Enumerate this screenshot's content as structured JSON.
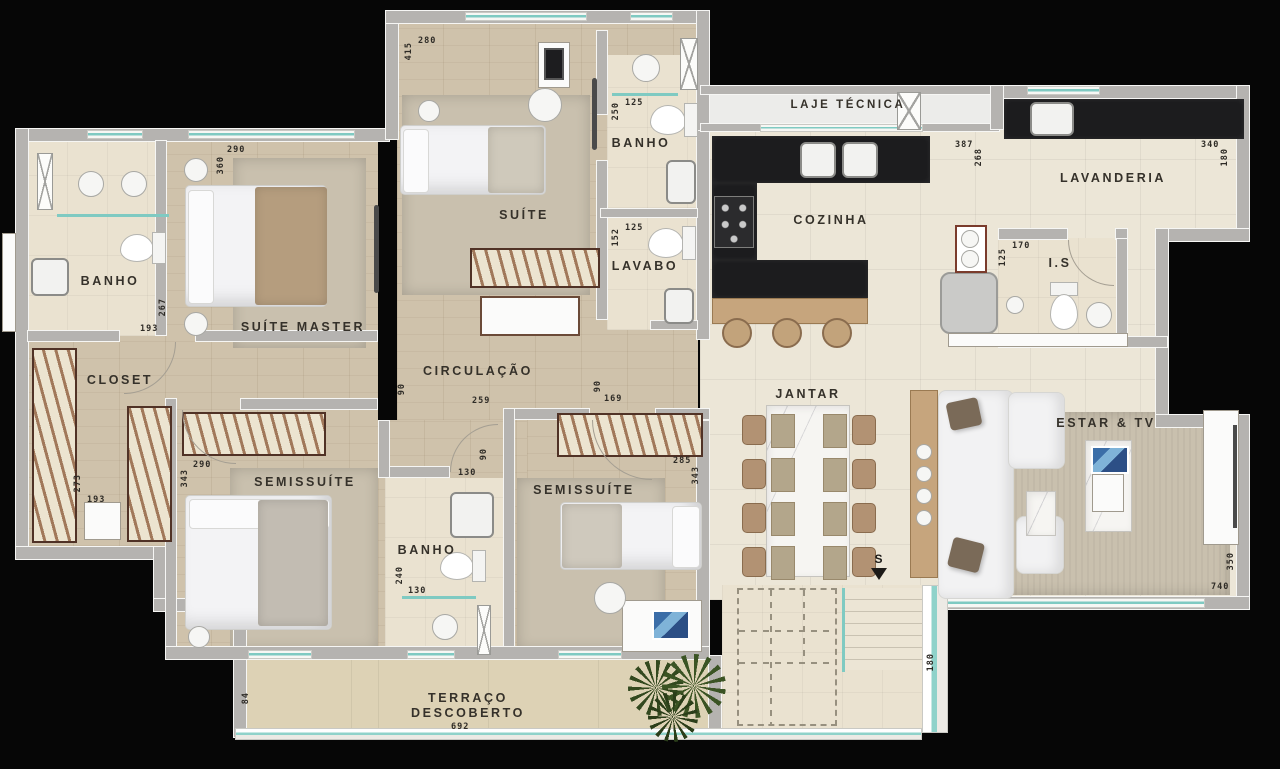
{
  "plan_type": "apartment-floor-plan",
  "palette": {
    "background": "#060606",
    "wall": "#b5b3b0",
    "wood_floor": "#cfc2ab",
    "tile_floor": "#ece6d7",
    "bath_floor": "#eae2d0",
    "terrace_floor": "#ddd2b5",
    "window_teal": "#7fcac2",
    "counter_black": "#1c1c1e",
    "label_color": "#35312a"
  },
  "rooms": {
    "banho_left": {
      "label": "BANHO",
      "dim_w": "193",
      "dim_h": "267"
    },
    "suite_master": {
      "label": "SUÍTE MASTER",
      "dim_w": "290",
      "dim_h": "360"
    },
    "closet": {
      "label": "CLOSET",
      "dim_w": "193",
      "dim_h": "273"
    },
    "semissuite_1": {
      "label": "SEMISSUÍTE",
      "dim_w": "290",
      "dim_h": "343"
    },
    "suite": {
      "label": "SUÍTE",
      "dim_w": "280",
      "dim_h": "415"
    },
    "banho_top": {
      "label": "BANHO",
      "dim_w": "125",
      "dim_h": "250"
    },
    "lavabo": {
      "label": "LAVABO",
      "dim_w": "125",
      "dim_h": "152"
    },
    "circulacao": {
      "label": "CIRCULAÇÃO",
      "dim_w_left": "259",
      "dim_w_right": "169",
      "dim_door_left": "90",
      "dim_door_right": "90"
    },
    "banho_bottom": {
      "label": "BANHO",
      "dim_w": "130",
      "dim_h": "240",
      "dim_door": "130",
      "dim_hall": "90"
    },
    "semissuite_2": {
      "label": "SEMISSUÍTE",
      "dim_w": "285",
      "dim_h": "343"
    },
    "laje_tecnica": {
      "label": "LAJE TÉCNICA"
    },
    "cozinha": {
      "label": "COZINHA",
      "dim_w": "387",
      "dim_h": "268"
    },
    "lavanderia": {
      "label": "LAVANDERIA",
      "dim_w": "340",
      "dim_h": "180"
    },
    "is": {
      "label": "I.S",
      "dim_w": "170",
      "dim_h": "125"
    },
    "jantar": {
      "label": "JANTAR"
    },
    "estar_tv": {
      "label": "ESTAR & TV",
      "dim_w": "740",
      "dim_h": "350"
    },
    "terraco": {
      "label_line1": "TERRAÇO",
      "label_line2": "DESCOBERTO",
      "dim_w": "692",
      "dim_h": "84"
    },
    "stairs": {
      "label": "S",
      "dim_h": "180"
    }
  }
}
